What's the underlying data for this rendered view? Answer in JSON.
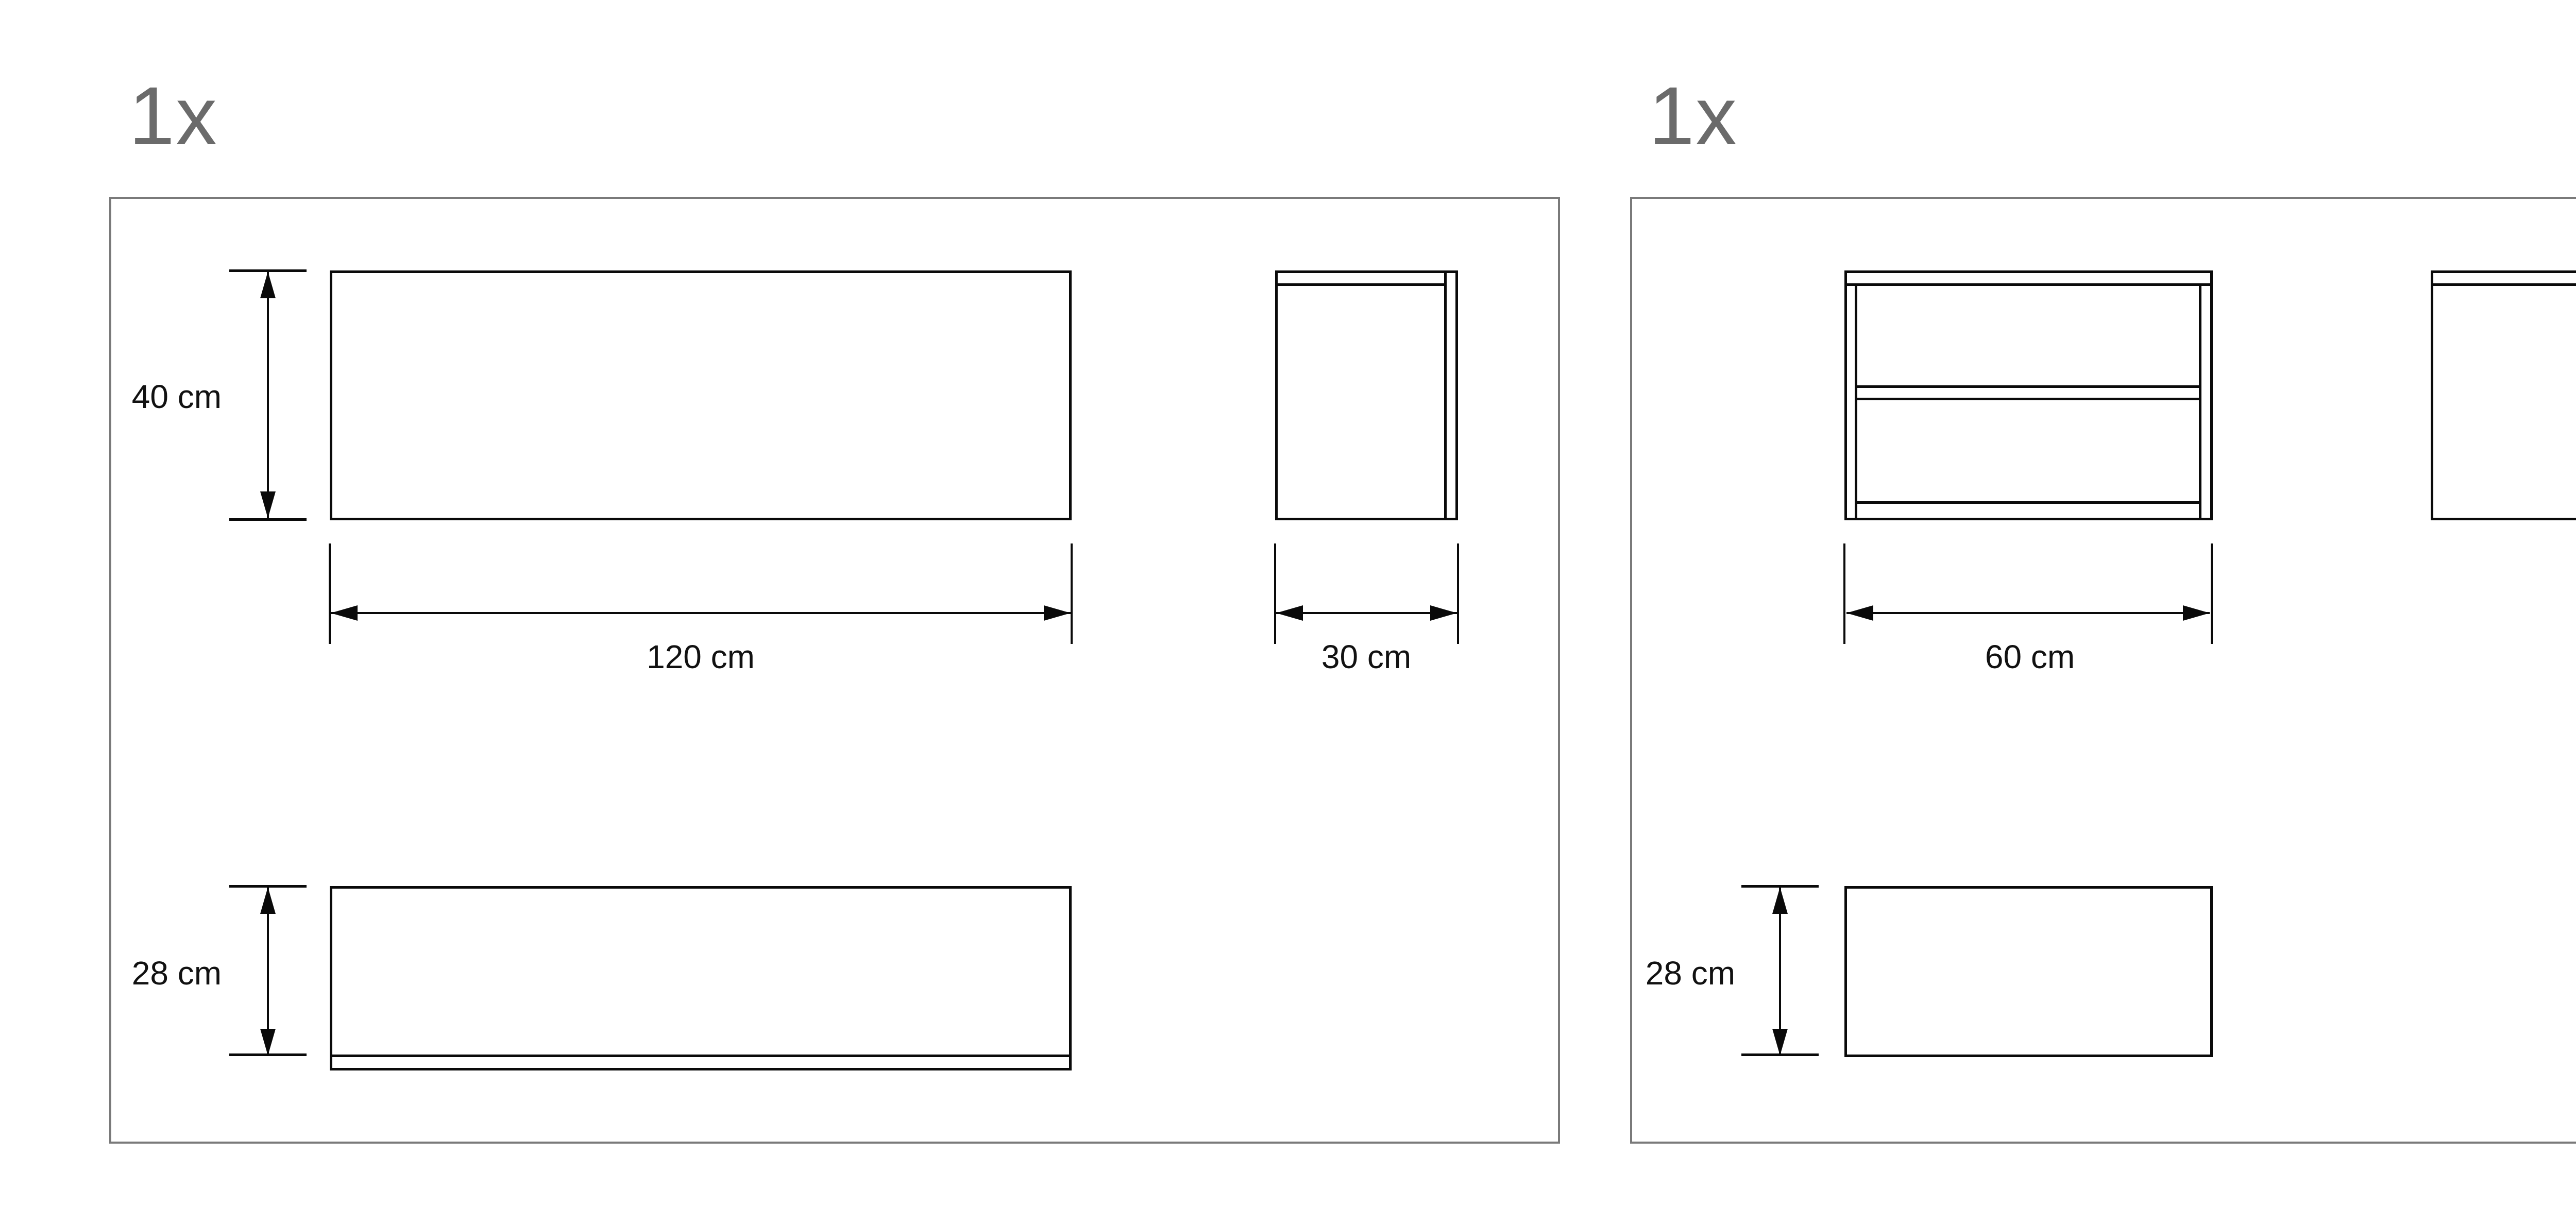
{
  "colors": {
    "line": "#0a0a0a",
    "frame": "#7a7a7a",
    "label": "#6b6b6b",
    "text": "#111111"
  },
  "panels": [
    {
      "name": "wide-cabinet",
      "quantity": "1x",
      "front_height_label": "40 cm",
      "front_width_label": "120 cm",
      "side_width_label": "30 cm",
      "base_height_label": "28 cm"
    },
    {
      "name": "open-shelf-cabinet",
      "quantity": "1x",
      "front_width_label": "60 cm",
      "side_height_label": "40 cm",
      "base_height_label": "28 cm"
    },
    {
      "name": "small-cabinet",
      "quantity": "1x",
      "front_height_label": "40 cm",
      "front_width_label": "60 cm",
      "side_width_label": "30 cm",
      "base_height_label": "28 cm"
    }
  ]
}
